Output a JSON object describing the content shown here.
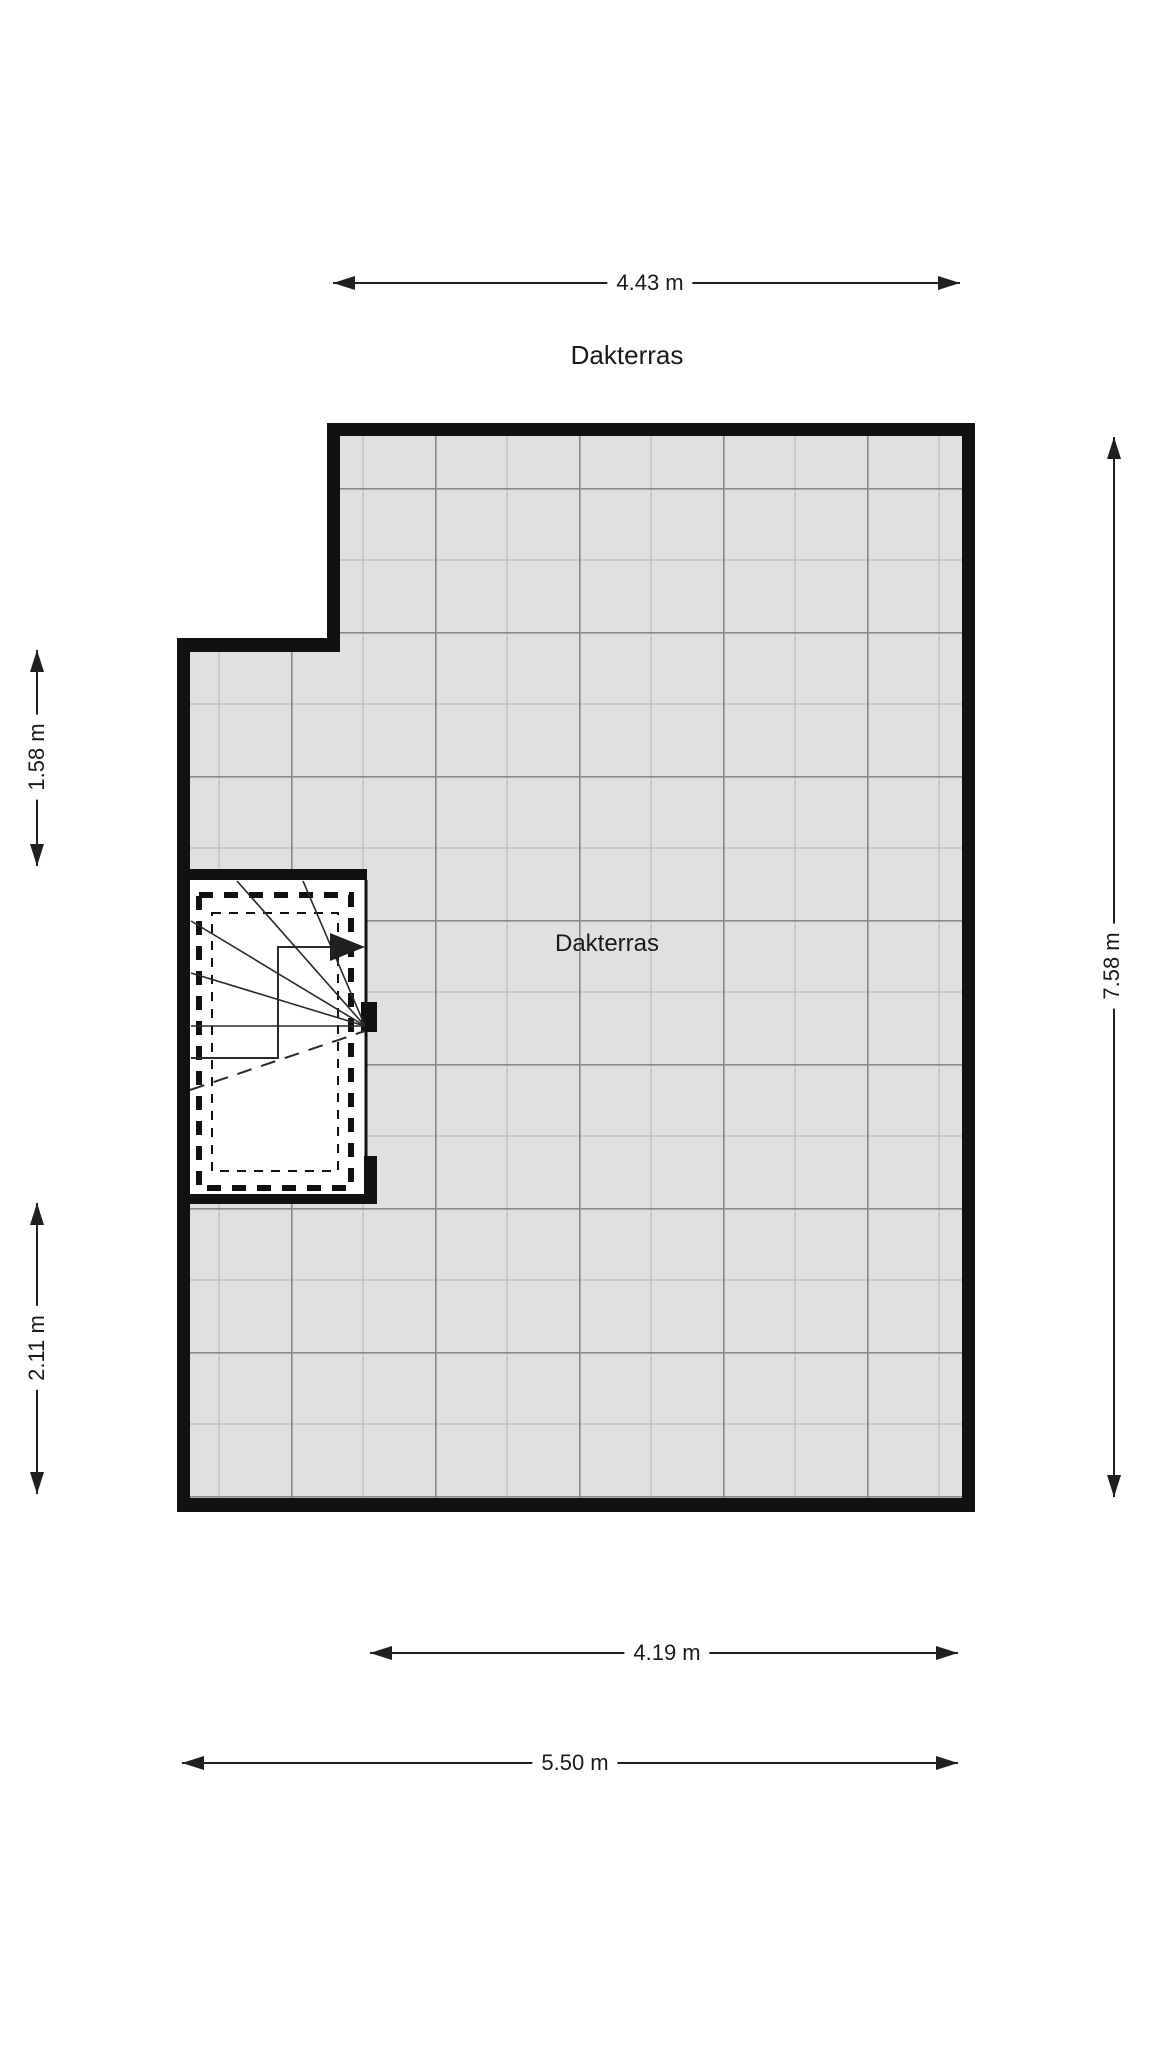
{
  "title": "Dakterras",
  "room": {
    "label": "Dakterras"
  },
  "dimensions": {
    "top": "4.43 m",
    "left_upper": "1.58 m",
    "left_lower": "2.11 m",
    "right": "7.58 m",
    "bottom_inner": "4.19 m",
    "bottom_outer": "5.50 m"
  },
  "colors": {
    "wall": "#111111",
    "tile": "#e0e0e0",
    "grid_line": "#8a8a8a",
    "grid_line_light": "#c2c2c2",
    "dimension": "#1f1f1f",
    "background": "#ffffff",
    "text": "#1a1a1a"
  }
}
